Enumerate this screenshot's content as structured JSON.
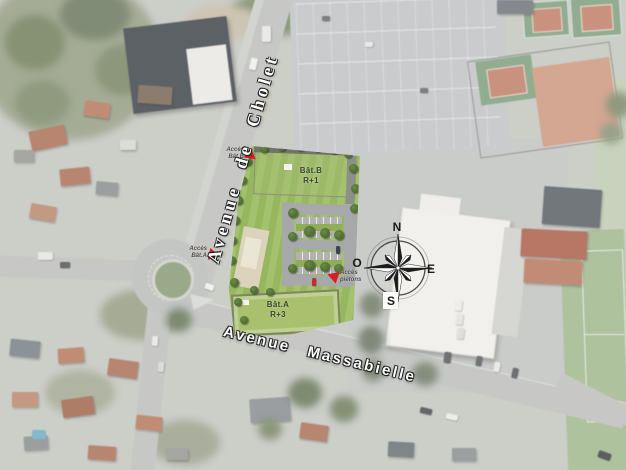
{
  "map": {
    "streets": {
      "cholet": "Avenue de Cholet",
      "massabielle": "Avenue Massabielle"
    },
    "buildings": {
      "bat_b": {
        "name": "Bât.B",
        "level": "R+1"
      },
      "bat_a": {
        "name": "Bât.A",
        "level": "R+3"
      }
    },
    "access": {
      "bat_b": {
        "line1": "Accès",
        "line2": "Bât.B"
      },
      "bat_a": {
        "line1": "Accès",
        "line2": "Bât.A"
      },
      "pedestrian": {
        "line1": "Accès",
        "line2": "piétons"
      }
    },
    "compass": {
      "n": "N",
      "e": "E",
      "s": "S",
      "w": "O"
    },
    "colors": {
      "marker_red": "#d41f26",
      "lawn_green": "#9cbd62",
      "roof_green": "#a9c06e",
      "road_gray": "#c0c2bf"
    }
  }
}
